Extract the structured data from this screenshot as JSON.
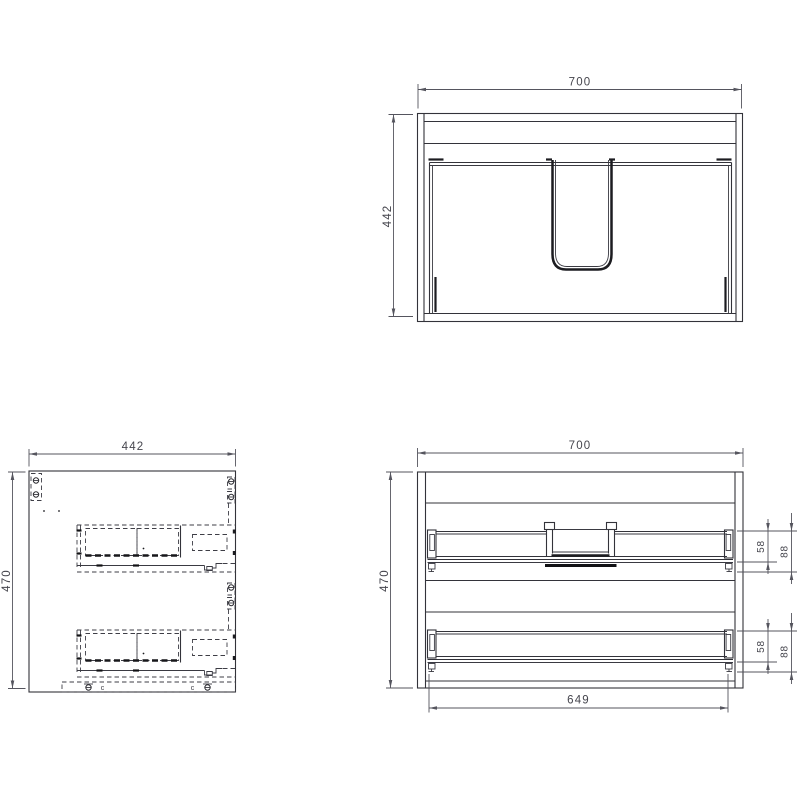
{
  "drawing": {
    "views": {
      "top": {
        "label": "cabinet-top-view",
        "dim_width": "700",
        "dim_depth": "442"
      },
      "side": {
        "label": "cabinet-side-view",
        "dim_depth": "442",
        "dim_height": "470",
        "mark_left": "c",
        "mark_right": "c"
      },
      "front": {
        "label": "cabinet-front-view",
        "dim_width": "700",
        "dim_height": "470",
        "dim_inner_width": "649",
        "upper_rail": {
          "dim_rail_height": "58",
          "dim_bracket_height": "88"
        },
        "lower_rail": {
          "dim_rail_height": "58",
          "dim_bracket_height": "88"
        }
      }
    },
    "colors": {
      "line": "#33333a",
      "dimension": "#55555e",
      "background": "#ffffff"
    }
  }
}
